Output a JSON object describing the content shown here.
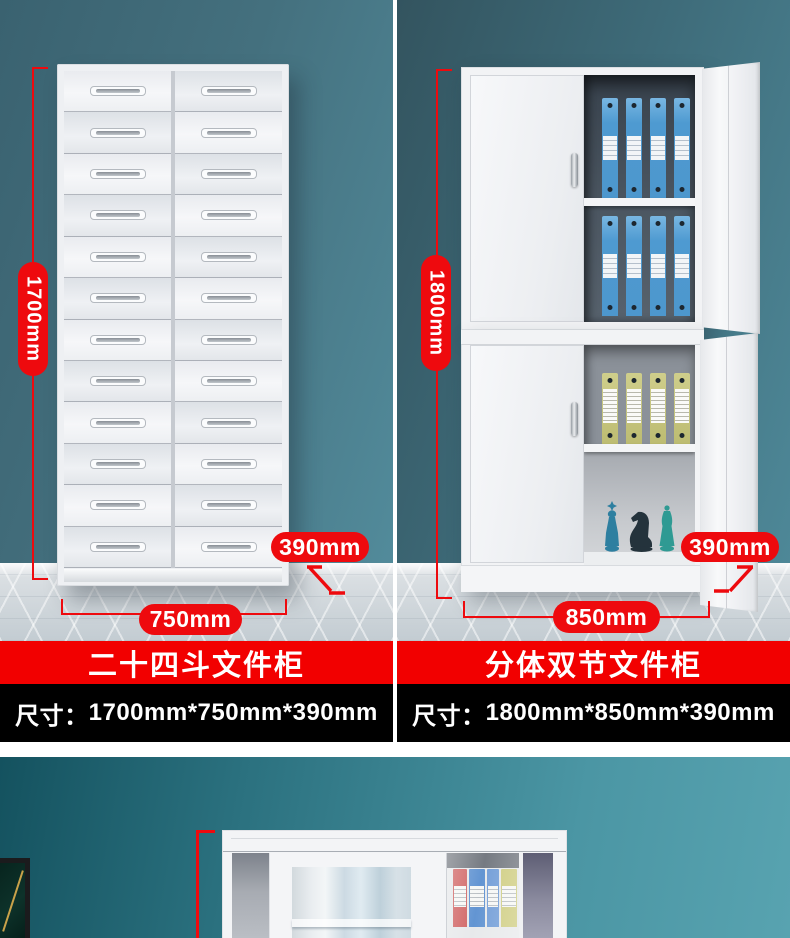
{
  "colors": {
    "annotation_red": "#ee0a0e",
    "banner_red": "#f20000",
    "banner_black": "#000000",
    "wall_teal": "#44707e",
    "floor_grey": "#cdd4d9"
  },
  "products": {
    "left": {
      "name": "二十四斗文件柜",
      "size_prefix": "尺寸：",
      "size_text": "1700mm*750mm*390mm",
      "height_label": "1700mm",
      "width_label": "750mm",
      "depth_label": "390mm",
      "drawer_rows": 12,
      "drawer_columns": 2
    },
    "right": {
      "name": "分体双节文件柜",
      "size_prefix": "尺寸：",
      "size_text": "1800mm*850mm*390mm",
      "height_label": "1800mm",
      "width_label": "850mm",
      "depth_label": "390mm",
      "binders_per_shelf": 4,
      "top_unit_shelves": 2,
      "bottom_unit_shelves": 1
    }
  }
}
